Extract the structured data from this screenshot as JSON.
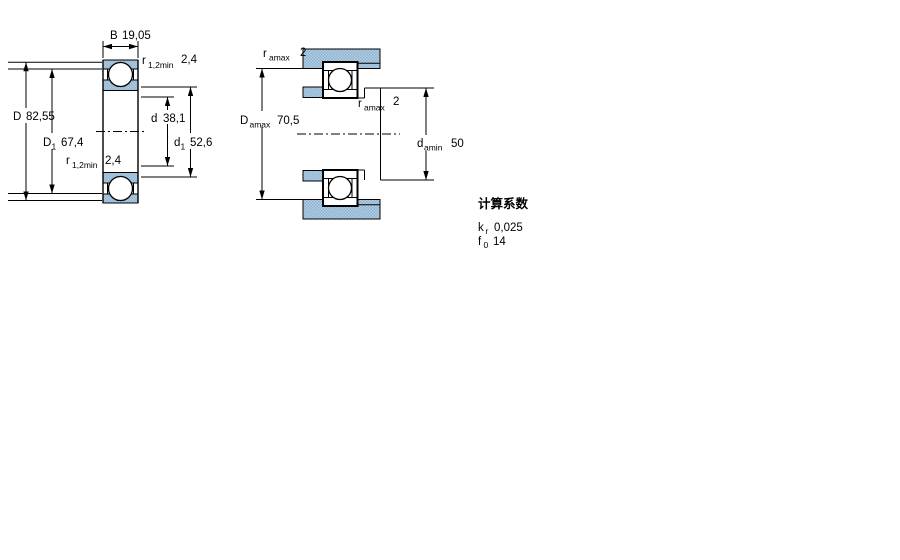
{
  "figure_left": {
    "dims": {
      "B": {
        "letter": "B",
        "sub": "",
        "value": "19,05"
      },
      "r12_top": {
        "letter": "r",
        "sub": "1,2min",
        "value": "2,4"
      },
      "D": {
        "letter": "D",
        "sub": "",
        "value": "82,55"
      },
      "D1": {
        "letter": "D",
        "sub": "1",
        "value": "67,4"
      },
      "r12_bottom": {
        "letter": "r",
        "sub": "1,2min",
        "value": "2,4"
      },
      "d": {
        "letter": "d",
        "sub": "",
        "value": "38,1"
      },
      "d1": {
        "letter": "d",
        "sub": "1",
        "value": "52,6"
      }
    }
  },
  "figure_right": {
    "dims": {
      "ra_top": {
        "letter": "r",
        "sub": "amax",
        "value": "2"
      },
      "Da": {
        "letter": "D",
        "sub": "amax",
        "value": "70,5"
      },
      "ra_mid": {
        "letter": "r",
        "sub": "amax",
        "value": "2"
      },
      "da": {
        "letter": "d",
        "sub": "amin",
        "value": "50"
      }
    }
  },
  "factors": {
    "heading": "计算系数",
    "rows": [
      {
        "letter": "k",
        "sub": "r",
        "value": "0,025"
      },
      {
        "letter": "f",
        "sub": "0",
        "value": "14"
      }
    ]
  },
  "colors": {
    "hatch_base": "#b5d0e3",
    "hatch_dot": "#8db1cf",
    "line": "#000000",
    "background": "#ffffff"
  }
}
